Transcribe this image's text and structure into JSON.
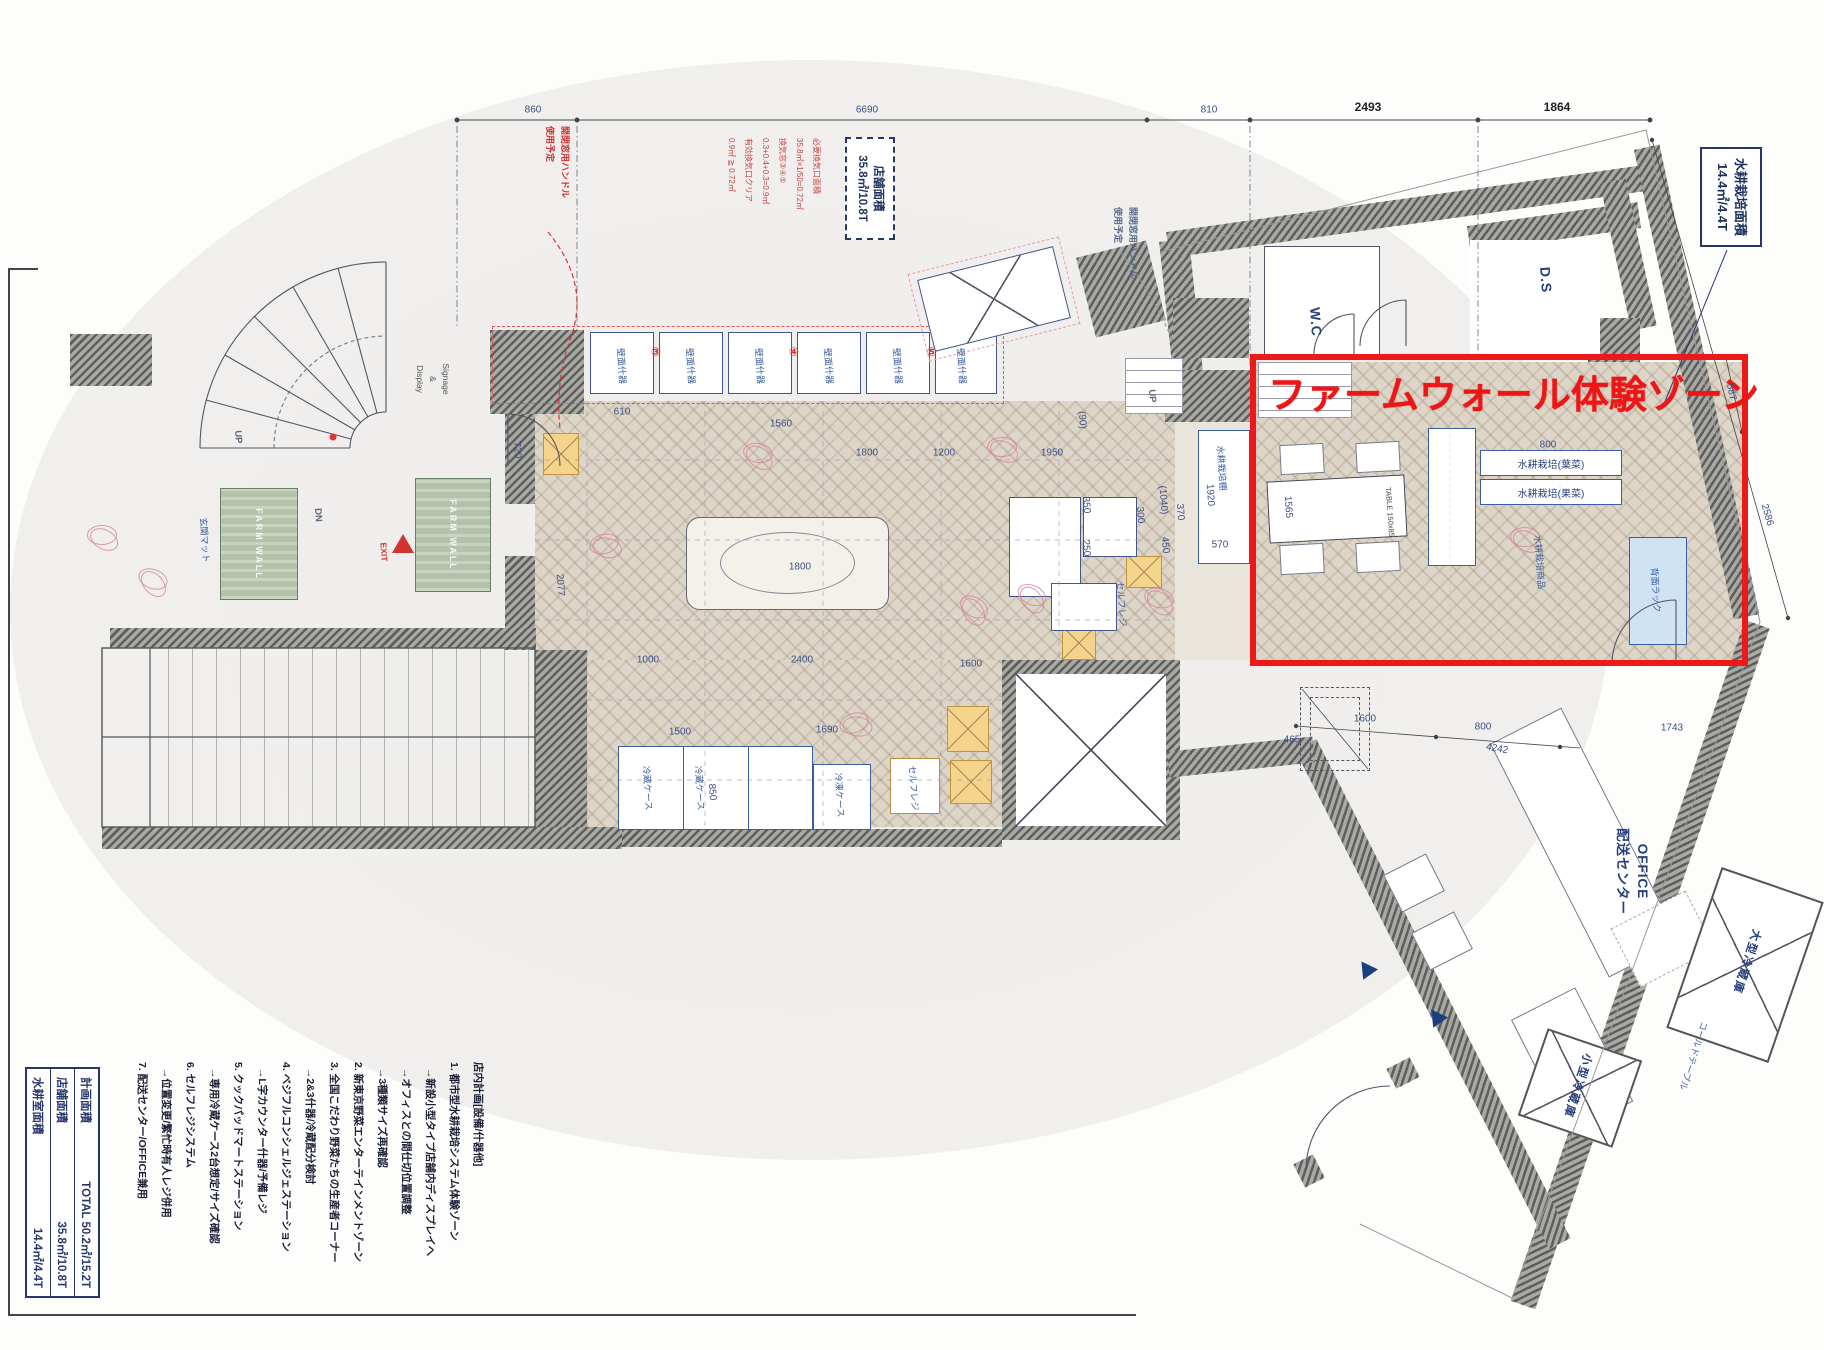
{
  "colors": {
    "accent_red": "#ee1818",
    "ink_navy": "#26366b",
    "dim_blue": "#3c4f86",
    "wall_gray": "#9b9b97",
    "floor_beige": "#ddd5c7",
    "mat_green": "#b5c2aa",
    "stamp_red": "#c84444",
    "rack_blue": "#3a5fa0"
  },
  "farm_zone": {
    "title": "ファームウォール体験ゾーン"
  },
  "hydro_area_box": {
    "line1": "水耕栽培面積",
    "line2": "14.4㎡/4.4T"
  },
  "store_area_box": {
    "line1": "店舗面積",
    "line2": "35.8㎡/10.8T"
  },
  "vent_note": {
    "lines": [
      "必要換気口面積",
      "35.8㎡×1/50=0.72㎡",
      "換気窓③④⑤",
      "0.3+0.4+0.3=0.9㎡",
      "有効換気口クリア",
      "0.9㎡ ≧ 0.72㎡"
    ]
  },
  "handle_note_red": {
    "lines": [
      "開閉窓用ハンドル",
      "使用予定"
    ]
  },
  "handle_note_gray": {
    "lines": [
      "開閉窓用ハンドル",
      "使用予定"
    ]
  },
  "signage": {
    "lines": [
      "Signage",
      "&",
      "Display"
    ]
  },
  "office_label": {
    "lines": [
      "OFFICE",
      "配送センター"
    ]
  },
  "plan_notes": {
    "lines": [
      "店内計画[設備/什器他]",
      "1. 都市型水耕栽培システム体験ゾーン",
      "  →新設小型タイプ店舗内ディスプレイへ",
      "  →オフィスとの間仕切位置調整",
      "  →3種類サイズ再確認",
      "2. 新東京野菜エンターテインメントゾーン",
      "3. 全国こだわり野菜たちの生産者コーナー",
      "  →2&3什器/冷蔵配分検討",
      "4. ベジフルコンシェルジェステーション",
      "  →L字カウンター什器/予備レジ",
      "5. クックパッドマートステーション",
      "  →専用冷蔵ケース2台想定/サイズ確認",
      "6. セルフレジシステム",
      "  →位置変更/繁忙時有人レジ併用",
      "7. 配送センター/OFFICE兼用"
    ]
  },
  "area_table": {
    "rows": [
      {
        "label": "計画面積",
        "value": "TOTAL 50.2㎡/15.2T"
      },
      {
        "label": "店舗面積",
        "value": "35.8㎡/10.8T"
      },
      {
        "label": "水耕室面積",
        "value": "14.4㎡/4.4T"
      }
    ]
  },
  "rack_labels": {
    "leaf": "水耕栽培(葉菜)",
    "fruit": "水耕栽培(果菜)"
  },
  "mat_label": "FARM WALL",
  "labels": [
    [
      "860",
      533,
      110,
      0,
      "dim"
    ],
    [
      "6690",
      867,
      110,
      0,
      "dim"
    ],
    [
      "810",
      1209,
      110,
      0,
      "dim"
    ],
    [
      "2493",
      1368,
      107,
      0,
      "dimb"
    ],
    [
      "1864",
      1557,
      107,
      0,
      "dimb"
    ],
    [
      "587",
      1731,
      392,
      78,
      "dim"
    ],
    [
      "2586",
      1767,
      515,
      74,
      "dim"
    ],
    [
      "720",
      517,
      450,
      86,
      "dim"
    ],
    [
      "2077",
      560,
      585,
      86,
      "dim"
    ],
    [
      "610",
      622,
      412,
      0,
      "dim"
    ],
    [
      "1560",
      781,
      424,
      0,
      "dim"
    ],
    [
      "1800",
      867,
      453,
      0,
      "dim"
    ],
    [
      "1200",
      944,
      453,
      0,
      "dim"
    ],
    [
      "1950",
      1052,
      453,
      0,
      "dim"
    ],
    [
      "(1040)",
      1163,
      500,
      86,
      "dim"
    ],
    [
      "1000",
      648,
      660,
      0,
      "dim"
    ],
    [
      "2400",
      802,
      660,
      0,
      "dim"
    ],
    [
      "1500",
      680,
      732,
      0,
      "dim"
    ],
    [
      "1690",
      827,
      730,
      0,
      "dim"
    ],
    [
      "1600",
      971,
      664,
      0,
      "dim"
    ],
    [
      "850",
      712,
      792,
      86,
      "dim"
    ],
    [
      "350",
      1086,
      505,
      86,
      "dim"
    ],
    [
      "250",
      1086,
      548,
      86,
      "dim"
    ],
    [
      "300",
      1140,
      515,
      86,
      "dim"
    ],
    [
      "450",
      1165,
      545,
      86,
      "dim"
    ],
    [
      "370",
      1180,
      512,
      86,
      "dim"
    ],
    [
      "(90)",
      1082,
      420,
      86,
      "dim"
    ],
    [
      "570",
      1220,
      545,
      0,
      "dim"
    ],
    [
      "1920",
      1210,
      495,
      86,
      "dim"
    ],
    [
      "1565",
      1288,
      507,
      86,
      "dim"
    ],
    [
      "800",
      1548,
      445,
      0,
      "dim"
    ],
    [
      "465",
      1292,
      740,
      0,
      "dim"
    ],
    [
      "1600",
      1365,
      719,
      0,
      "dim"
    ],
    [
      "800",
      1483,
      727,
      0,
      "dim"
    ],
    [
      "4242",
      1497,
      749,
      10,
      "dim"
    ],
    [
      "1743",
      1672,
      728,
      0,
      "dim"
    ],
    [
      "1800",
      800,
      567,
      0,
      "dim"
    ],
    [
      "W.C",
      1316,
      322,
      86,
      "room"
    ],
    [
      "D.S",
      1546,
      280,
      86,
      "room"
    ],
    [
      "UP",
      238,
      437,
      86,
      "small"
    ],
    [
      "UP",
      1152,
      396,
      86,
      "small"
    ],
    [
      "DN",
      318,
      515,
      86,
      "small"
    ],
    [
      "EXIT",
      384,
      552,
      86,
      "redsmall"
    ],
    [
      "壁面什器",
      622,
      366,
      86,
      "equip"
    ],
    [
      "壁面什器",
      691,
      366,
      86,
      "equip"
    ],
    [
      "壁面什器",
      760,
      366,
      86,
      "equip"
    ],
    [
      "壁面什器",
      829,
      366,
      86,
      "equip"
    ],
    [
      "壁面什器",
      898,
      366,
      86,
      "equip"
    ],
    [
      "壁面什器",
      962,
      366,
      86,
      "equip"
    ],
    [
      "③",
      656,
      352,
      0,
      "redmark"
    ],
    [
      "④",
      794,
      352,
      0,
      "redmark"
    ],
    [
      "⑤",
      932,
      352,
      0,
      "redmark"
    ],
    [
      "冷蔵ケース",
      648,
      788,
      86,
      "equip"
    ],
    [
      "冷蔵ケース",
      700,
      788,
      86,
      "equip"
    ],
    [
      "冷凍ケース",
      840,
      795,
      86,
      "equip"
    ],
    [
      "セルフレジ",
      914,
      788,
      86,
      "equip"
    ],
    [
      "セルフレジ",
      1122,
      604,
      86,
      "equip"
    ],
    [
      "玄関マット",
      205,
      540,
      86,
      "equip"
    ],
    [
      "水耕栽培棚",
      1222,
      468,
      86,
      "equip"
    ],
    [
      "水耕栽培商品",
      1540,
      562,
      86,
      "equip"
    ],
    [
      "背面ラック",
      1656,
      590,
      86,
      "equip"
    ],
    [
      "TABLE 150x85",
      1390,
      512,
      86,
      "equip7"
    ],
    [
      "大型冷蔵庫",
      1747,
      962,
      108,
      "equipB"
    ],
    [
      "小型冷蔵庫",
      1578,
      1086,
      108,
      "equipB"
    ],
    [
      "コールドテーブル",
      1694,
      1056,
      108,
      "equip"
    ]
  ],
  "scribbles": [
    [
      102,
      535,
      0
    ],
    [
      153,
      579,
      20
    ],
    [
      604,
      544,
      -15
    ],
    [
      758,
      453,
      10
    ],
    [
      1002,
      447,
      0
    ],
    [
      1032,
      595,
      25
    ],
    [
      854,
      723,
      -20
    ],
    [
      1159,
      598,
      15
    ],
    [
      1525,
      537,
      0
    ],
    [
      974,
      607,
      30
    ]
  ]
}
